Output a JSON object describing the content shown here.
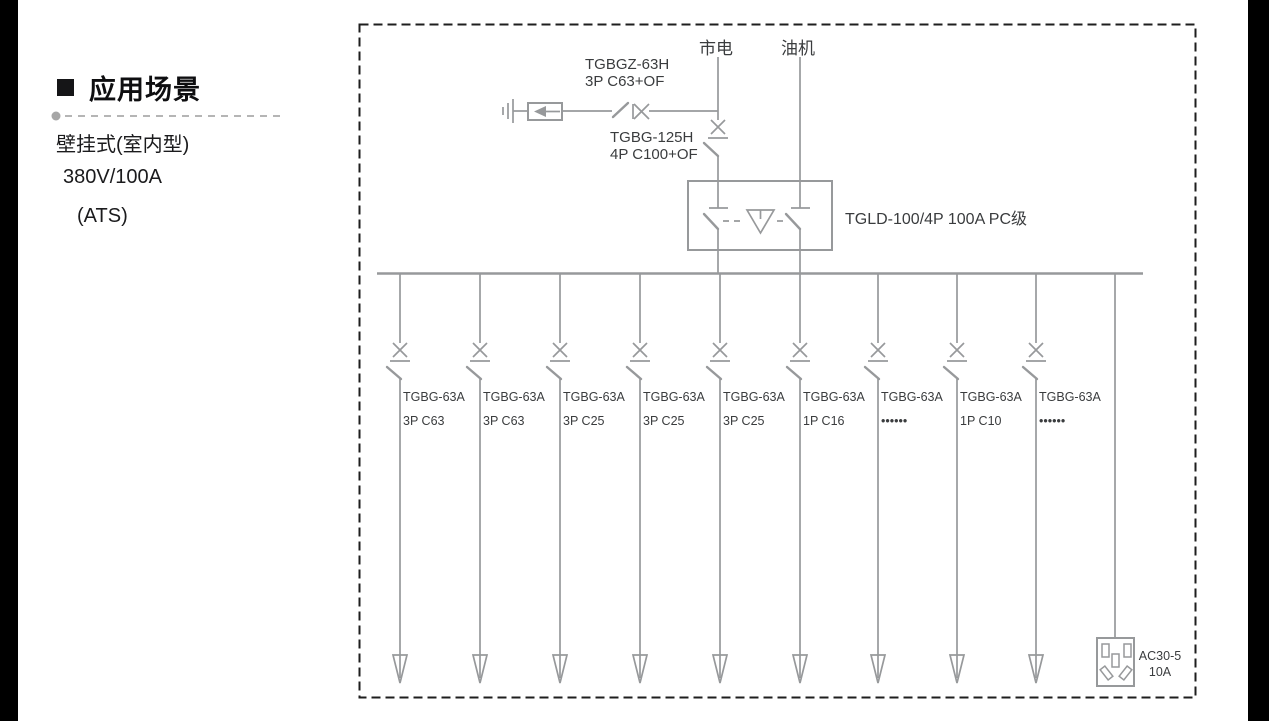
{
  "colors": {
    "line_gray": "#97999b",
    "text_dark": "#3a3c3e",
    "title_black": "#0e0e10",
    "border_black": "#1e1e1e",
    "edge_bars": "#000000"
  },
  "sidebar": {
    "bullet": "■",
    "title": "应用场景",
    "subtitle_lines": [
      "壁挂式(室内型)",
      "380V/100A",
      "(ATS)"
    ]
  },
  "diagram": {
    "source_mains": "市电",
    "source_generator": "油机",
    "spd_breaker_model": "TGBGZ-63H",
    "spd_breaker_spec": "3P C63+OF",
    "main_breaker_model": "TGBG-125H",
    "main_breaker_spec": "4P C100+OF",
    "ats_label": "TGLD-100/4P 100A PC级",
    "branches": [
      {
        "model": "TGBG-63A",
        "spec": "3P C63"
      },
      {
        "model": "TGBG-63A",
        "spec": "3P C63"
      },
      {
        "model": "TGBG-63A",
        "spec": "3P C25"
      },
      {
        "model": "TGBG-63A",
        "spec": "3P C25"
      },
      {
        "model": "TGBG-63A",
        "spec": "3P C25"
      },
      {
        "model": "TGBG-63A",
        "spec": "1P C16"
      },
      {
        "model": "TGBG-63A",
        "spec": "••••••"
      },
      {
        "model": "TGBG-63A",
        "spec": "1P C10"
      },
      {
        "model": "TGBG-63A",
        "spec": "••••••"
      }
    ],
    "socket_model": "AC30-5",
    "socket_rating": "10A"
  }
}
